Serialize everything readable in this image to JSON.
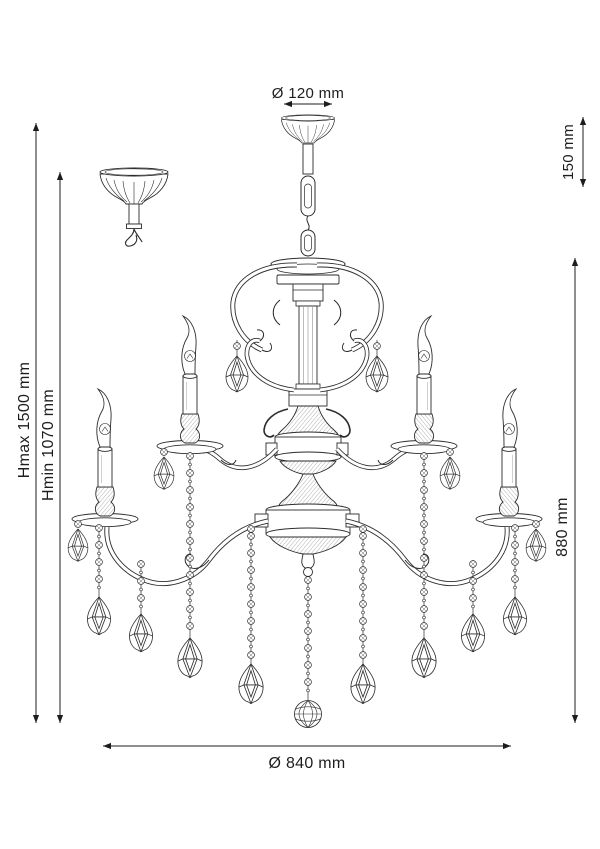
{
  "figure": {
    "subject": "chandelier technical line drawing",
    "background": "#ffffff",
    "line_color": "#2b2b2b",
    "dimension_color": "#1d1d1d"
  },
  "dimensions": {
    "top_diameter": "Ø 120 mm",
    "suspension_height": "150 mm",
    "hmax": "Hmax 1500 mm",
    "hmin": "Hmin 1070 mm",
    "fixture_height": "880 mm",
    "fixture_diameter": "Ø 840 mm"
  }
}
